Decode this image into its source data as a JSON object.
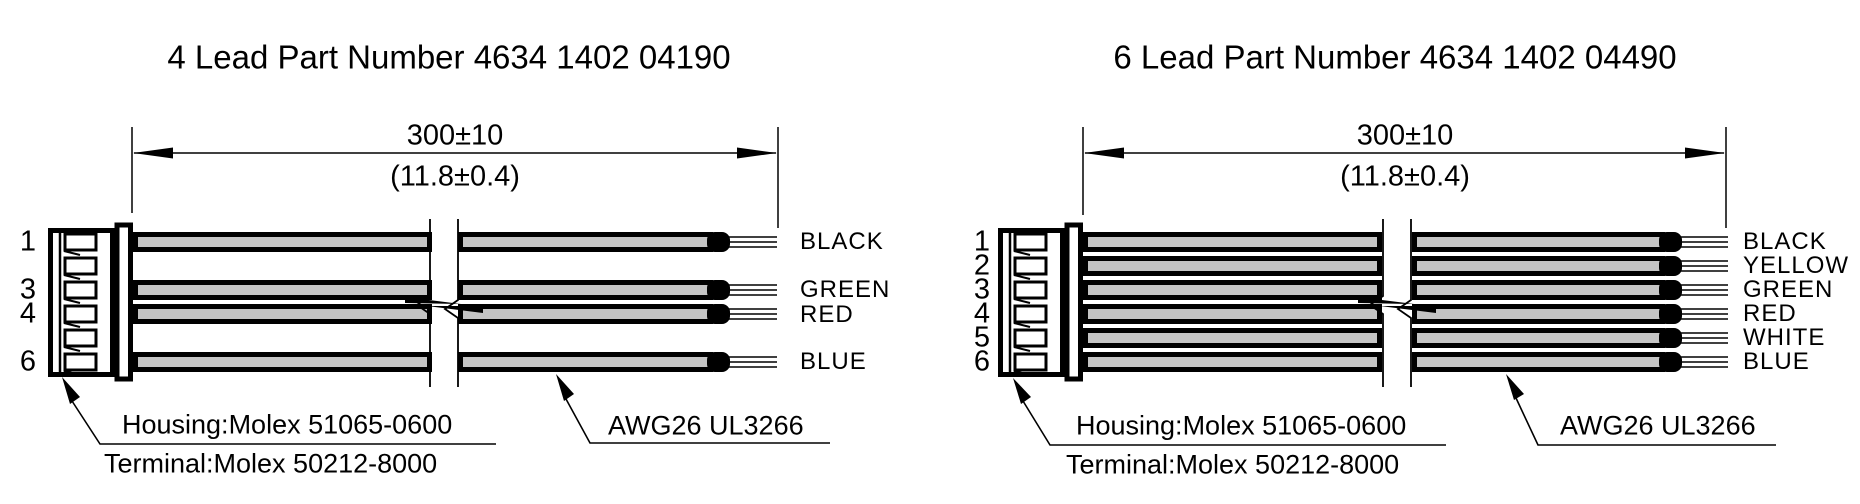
{
  "document_type": "wire harness technical drawing",
  "colors": {
    "line": "#000000",
    "wire_fill": "#c4c4c4",
    "background": "#ffffff"
  },
  "figures": [
    {
      "title": "4 Lead Part Number 4634 1402 04190",
      "dimension": {
        "mm": "300±10",
        "inch": "(11.8±0.4)"
      },
      "wires": [
        {
          "pin": "1",
          "label": "BLACK"
        },
        {
          "pin": "3",
          "label": "GREEN"
        },
        {
          "pin": "4",
          "label": "RED"
        },
        {
          "pin": "6",
          "label": "BLUE"
        }
      ],
      "callouts": {
        "housing": "Housing:Molex 51065-0600",
        "terminal": "Terminal:Molex 50212-8000",
        "wire_spec": "AWG26 UL3266"
      }
    },
    {
      "title": "6 Lead Part Number 4634 1402 04490",
      "dimension": {
        "mm": "300±10",
        "inch": "(11.8±0.4)"
      },
      "wires": [
        {
          "pin": "1",
          "label": "BLACK"
        },
        {
          "pin": "2",
          "label": "YELLOW"
        },
        {
          "pin": "3",
          "label": "GREEN"
        },
        {
          "pin": "4",
          "label": "RED"
        },
        {
          "pin": "5",
          "label": "WHITE"
        },
        {
          "pin": "6",
          "label": "BLUE"
        }
      ],
      "callouts": {
        "housing": "Housing:Molex 51065-0600",
        "terminal": "Terminal:Molex 50212-8000",
        "wire_spec": "AWG26 UL3266"
      }
    }
  ]
}
